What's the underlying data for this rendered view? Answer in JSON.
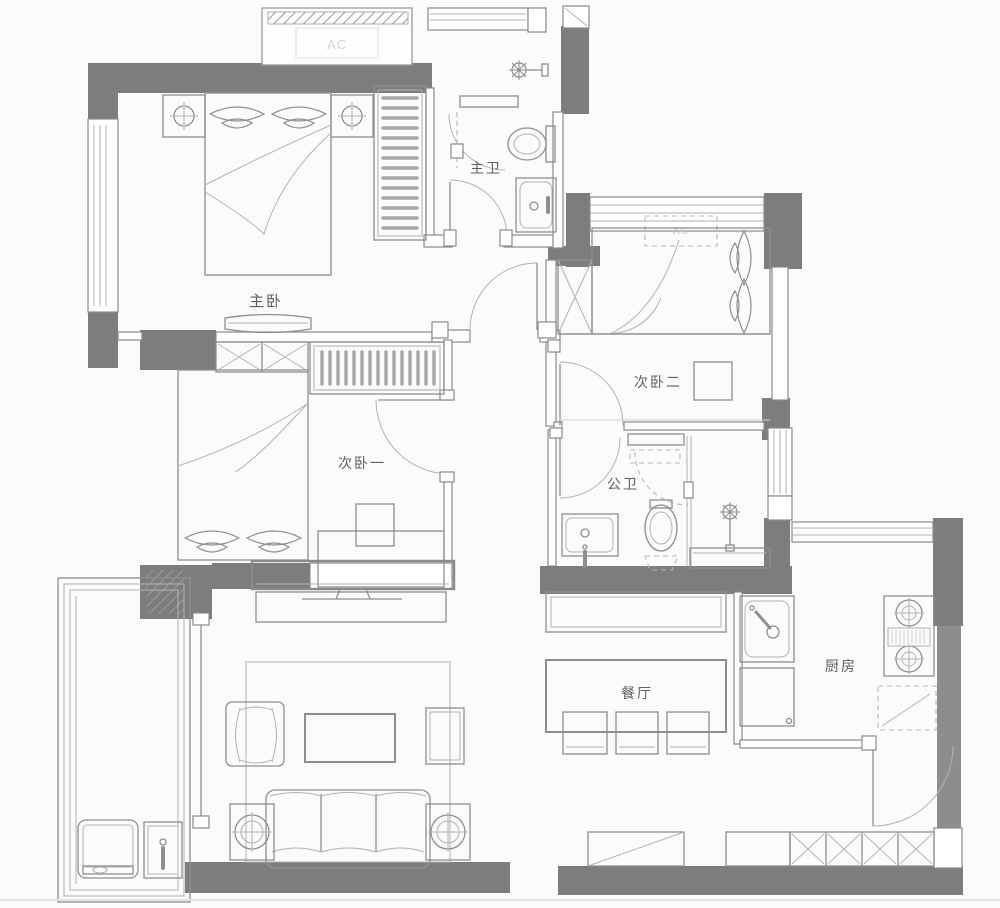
{
  "plan": {
    "type": "apartment-floor-plan",
    "colors": {
      "wall": "#7d7d7d",
      "line": "#8e8e8e",
      "background": "#fbfbfa",
      "label": "#5f5f5f"
    },
    "rooms": [
      {
        "id": "master-bedroom",
        "label": "主卧"
      },
      {
        "id": "master-bathroom",
        "label": "主卫"
      },
      {
        "id": "bedroom-two",
        "label": "次卧二"
      },
      {
        "id": "bedroom-one",
        "label": "次卧一"
      },
      {
        "id": "shared-bathroom",
        "label": "公卫"
      },
      {
        "id": "dining-room",
        "label": "餐厅"
      },
      {
        "id": "kitchen",
        "label": "厨房"
      }
    ],
    "annotations": [
      {
        "id": "ac-platform-top",
        "label": "AC"
      },
      {
        "id": "ac-bedroom-two",
        "label": "AC"
      }
    ]
  }
}
